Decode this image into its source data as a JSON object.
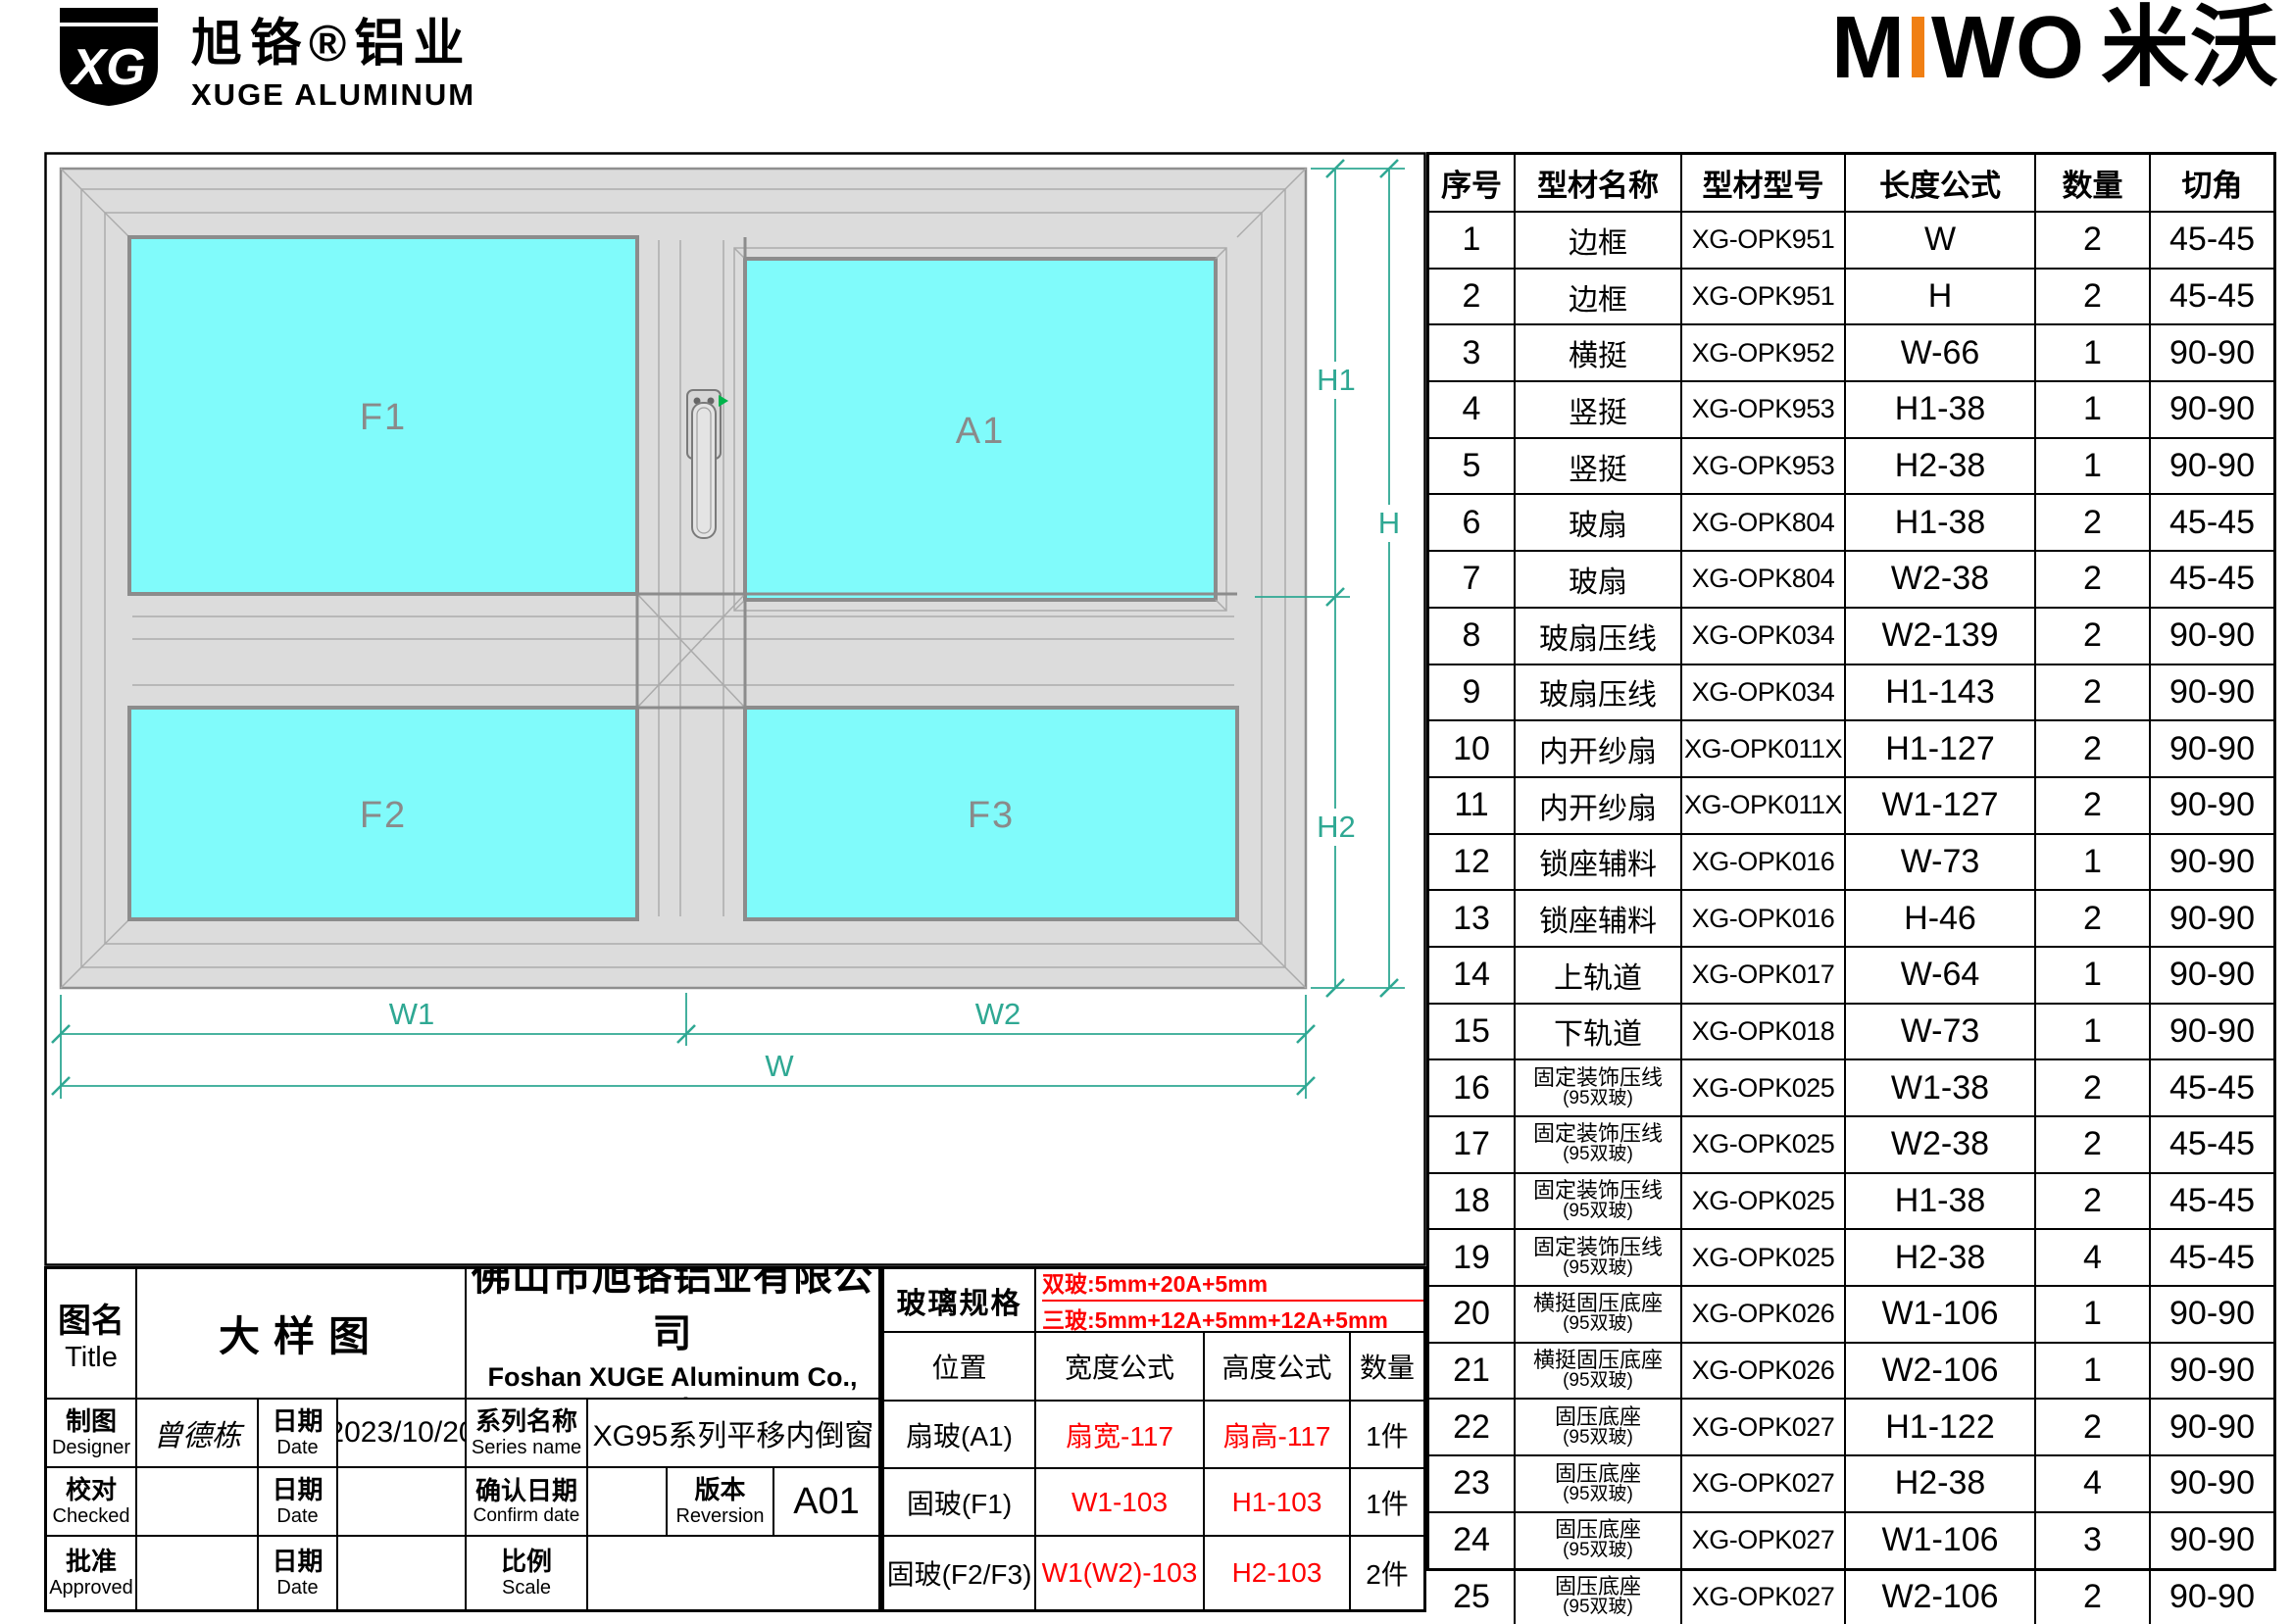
{
  "branding": {
    "xg_logo_monogram": "XG",
    "xg_brand_cn": "旭铬®铝业",
    "xg_brand_en": "XUGE ALUMINUM",
    "miwo_m": "M",
    "miwo_i": "I",
    "miwo_wo": "WO",
    "miwo_cn": "米沃",
    "miwo_orange": "#F07F13"
  },
  "drawing": {
    "panes": {
      "f1": "F1",
      "a1": "A1",
      "f2": "F2",
      "f3": "F3"
    },
    "dims": {
      "w1": "W1",
      "w2": "W2",
      "w": "W",
      "h1": "H1",
      "h2": "H2",
      "h": "H"
    },
    "colors": {
      "glass": "#80FBFB",
      "frame": "#DCDCDC",
      "frame_edge": "#8C8C8C",
      "dimension": "#2FA893",
      "pane_label": "#8A8A8A",
      "handle_green": "#00B44B"
    }
  },
  "parts_table": {
    "headers": [
      "序号",
      "型材名称",
      "型材型号",
      "长度公式",
      "数量",
      "切角"
    ],
    "rows": [
      {
        "no": "1",
        "name": "边框",
        "name2": "",
        "model": "XG-OPK951",
        "formula": "W",
        "qty": "2",
        "angle": "45-45"
      },
      {
        "no": "2",
        "name": "边框",
        "name2": "",
        "model": "XG-OPK951",
        "formula": "H",
        "qty": "2",
        "angle": "45-45"
      },
      {
        "no": "3",
        "name": "横挺",
        "name2": "",
        "model": "XG-OPK952",
        "formula": "W-66",
        "qty": "1",
        "angle": "90-90"
      },
      {
        "no": "4",
        "name": "竖挺",
        "name2": "",
        "model": "XG-OPK953",
        "formula": "H1-38",
        "qty": "1",
        "angle": "90-90"
      },
      {
        "no": "5",
        "name": "竖挺",
        "name2": "",
        "model": "XG-OPK953",
        "formula": "H2-38",
        "qty": "1",
        "angle": "90-90"
      },
      {
        "no": "6",
        "name": "玻扇",
        "name2": "",
        "model": "XG-OPK804",
        "formula": "H1-38",
        "qty": "2",
        "angle": "45-45"
      },
      {
        "no": "7",
        "name": "玻扇",
        "name2": "",
        "model": "XG-OPK804",
        "formula": "W2-38",
        "qty": "2",
        "angle": "45-45"
      },
      {
        "no": "8",
        "name": "玻扇压线",
        "name2": "",
        "model": "XG-OPK034",
        "formula": "W2-139",
        "qty": "2",
        "angle": "90-90"
      },
      {
        "no": "9",
        "name": "玻扇压线",
        "name2": "",
        "model": "XG-OPK034",
        "formula": "H1-143",
        "qty": "2",
        "angle": "90-90"
      },
      {
        "no": "10",
        "name": "内开纱扇",
        "name2": "",
        "model": "XG-OPK011X",
        "formula": "H1-127",
        "qty": "2",
        "angle": "90-90"
      },
      {
        "no": "11",
        "name": "内开纱扇",
        "name2": "",
        "model": "XG-OPK011X",
        "formula": "W1-127",
        "qty": "2",
        "angle": "90-90"
      },
      {
        "no": "12",
        "name": "锁座辅料",
        "name2": "",
        "model": "XG-OPK016",
        "formula": "W-73",
        "qty": "1",
        "angle": "90-90"
      },
      {
        "no": "13",
        "name": "锁座辅料",
        "name2": "",
        "model": "XG-OPK016",
        "formula": "H-46",
        "qty": "2",
        "angle": "90-90"
      },
      {
        "no": "14",
        "name": "上轨道",
        "name2": "",
        "model": "XG-OPK017",
        "formula": "W-64",
        "qty": "1",
        "angle": "90-90"
      },
      {
        "no": "15",
        "name": "下轨道",
        "name2": "",
        "model": "XG-OPK018",
        "formula": "W-73",
        "qty": "1",
        "angle": "90-90"
      },
      {
        "no": "16",
        "name": "固定装饰压线",
        "name2": "(95双玻)",
        "model": "XG-OPK025",
        "formula": "W1-38",
        "qty": "2",
        "angle": "45-45"
      },
      {
        "no": "17",
        "name": "固定装饰压线",
        "name2": "(95双玻)",
        "model": "XG-OPK025",
        "formula": "W2-38",
        "qty": "2",
        "angle": "45-45"
      },
      {
        "no": "18",
        "name": "固定装饰压线",
        "name2": "(95双玻)",
        "model": "XG-OPK025",
        "formula": "H1-38",
        "qty": "2",
        "angle": "45-45"
      },
      {
        "no": "19",
        "name": "固定装饰压线",
        "name2": "(95双玻)",
        "model": "XG-OPK025",
        "formula": "H2-38",
        "qty": "4",
        "angle": "45-45"
      },
      {
        "no": "20",
        "name": "横挺固压底座",
        "name2": "(95双玻)",
        "model": "XG-OPK026",
        "formula": "W1-106",
        "qty": "1",
        "angle": "90-90"
      },
      {
        "no": "21",
        "name": "横挺固压底座",
        "name2": "(95双玻)",
        "model": "XG-OPK026",
        "formula": "W2-106",
        "qty": "1",
        "angle": "90-90"
      },
      {
        "no": "22",
        "name": "固压底座",
        "name2": "(95双玻)",
        "model": "XG-OPK027",
        "formula": "H1-122",
        "qty": "2",
        "angle": "90-90"
      },
      {
        "no": "23",
        "name": "固压底座",
        "name2": "(95双玻)",
        "model": "XG-OPK027",
        "formula": "H2-38",
        "qty": "4",
        "angle": "90-90"
      },
      {
        "no": "24",
        "name": "固压底座",
        "name2": "(95双玻)",
        "model": "XG-OPK027",
        "formula": "W1-106",
        "qty": "3",
        "angle": "90-90"
      },
      {
        "no": "25",
        "name": "固压底座",
        "name2": "(95双玻)",
        "model": "XG-OPK027",
        "formula": "W2-106",
        "qty": "2",
        "angle": "90-90"
      }
    ]
  },
  "title_block": {
    "tuming_cn": "图名",
    "tuming_en": "Title",
    "drawing_title": "大样图",
    "company_cn": "佛山市旭铬铝业有限公司",
    "company_en": "Foshan XUGE Aluminum Co., Ltd.",
    "zhitu_cn": "制图",
    "zhitu_en": "Designer",
    "designer": "曾德栋",
    "riqi_cn": "日期",
    "riqi_en": "Date",
    "date": "2023/10/20",
    "series_cn": "系列名称",
    "series_en": "Series name",
    "series_value": "XG95系列平移内倒窗",
    "jiaodui_cn": "校对",
    "jiaodui_en": "Checked",
    "confirm_cn": "确认日期",
    "confirm_en": "Confirm date",
    "version_cn": "版本",
    "version_en": "Reversion",
    "version_value": "A01",
    "pizhun_cn": "批准",
    "pizhun_en": "Approved",
    "scale_cn": "比例",
    "scale_en": "Scale"
  },
  "glass_table": {
    "title": "玻璃规格",
    "spec_line1": "双玻:5mm+20A+5mm",
    "spec_line2": "三玻:5mm+12A+5mm+12A+5mm",
    "headers": [
      "位置",
      "宽度公式",
      "高度公式",
      "数量"
    ],
    "rows": [
      {
        "pos": "扇玻(A1)",
        "w": "扇宽-117",
        "h": "扇高-117",
        "qty": "1件"
      },
      {
        "pos": "固玻(F1)",
        "w": "W1-103",
        "h": "H1-103",
        "qty": "1件"
      },
      {
        "pos": "固玻(F2/F3)",
        "w": "W1(W2)-103",
        "h": "H2-103",
        "qty": "2件"
      }
    ]
  }
}
